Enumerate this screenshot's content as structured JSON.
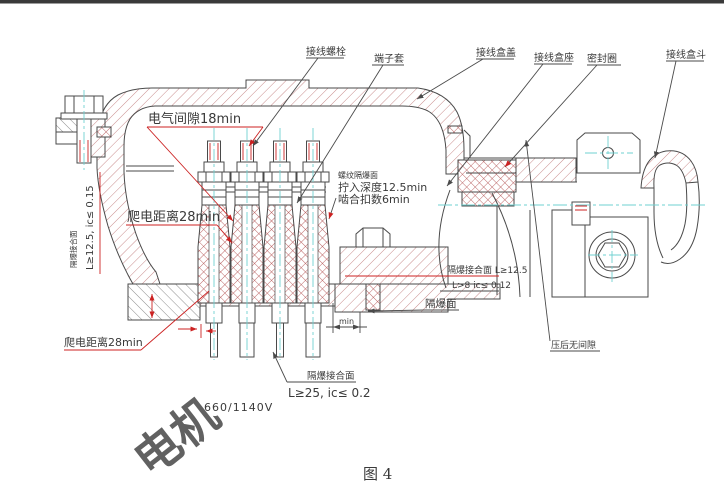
{
  "figure": {
    "caption": "图 4",
    "voltage_label": "660/1140V",
    "watermark": "电机"
  },
  "part_labels": {
    "terminal_bolt": "接线螺栓",
    "terminal_sleeve": "端子套",
    "box_cover": "接线盒盖",
    "box_seat": "接线盒座",
    "seal_ring": "密封圈",
    "box_hopper": "接线盒斗"
  },
  "annotations": {
    "electrical_clearance": "电气间隙18min",
    "creepage_upper": "爬电距离28min",
    "creepage_lower": "爬电距离28min",
    "thread_flameproof_title": "螺纹隔爆面",
    "thread_depth": "拧入深度12.5min",
    "thread_engagement": "啮合扣数6min",
    "left_joint_title": "隔爆接合面",
    "left_joint_spec": "L≥12.5, ic≤ 0.15",
    "seat_joint_spec1": "隔爆接合面 L≥12.5",
    "seat_joint_spec2": "L>8  ic≤ 0.12",
    "flameproof_face": "隔爆面",
    "no_gap_after_press": "压后无间隙",
    "bottom_joint_title": "隔爆接合面",
    "bottom_joint_spec": "L≥25, ic≤ 0.2",
    "min_dim": "min"
  },
  "colors": {
    "outline": "#4a4a4a",
    "hatch_red": "#c98c8c",
    "hatch_gray": "#8d8d8d",
    "crosshatch_red": "#b65858",
    "centerline_cyan": "#6fd0d0",
    "annotation_red": "#cc2222",
    "text": "#3a3a3a",
    "topbar": "#3a3a3a"
  }
}
